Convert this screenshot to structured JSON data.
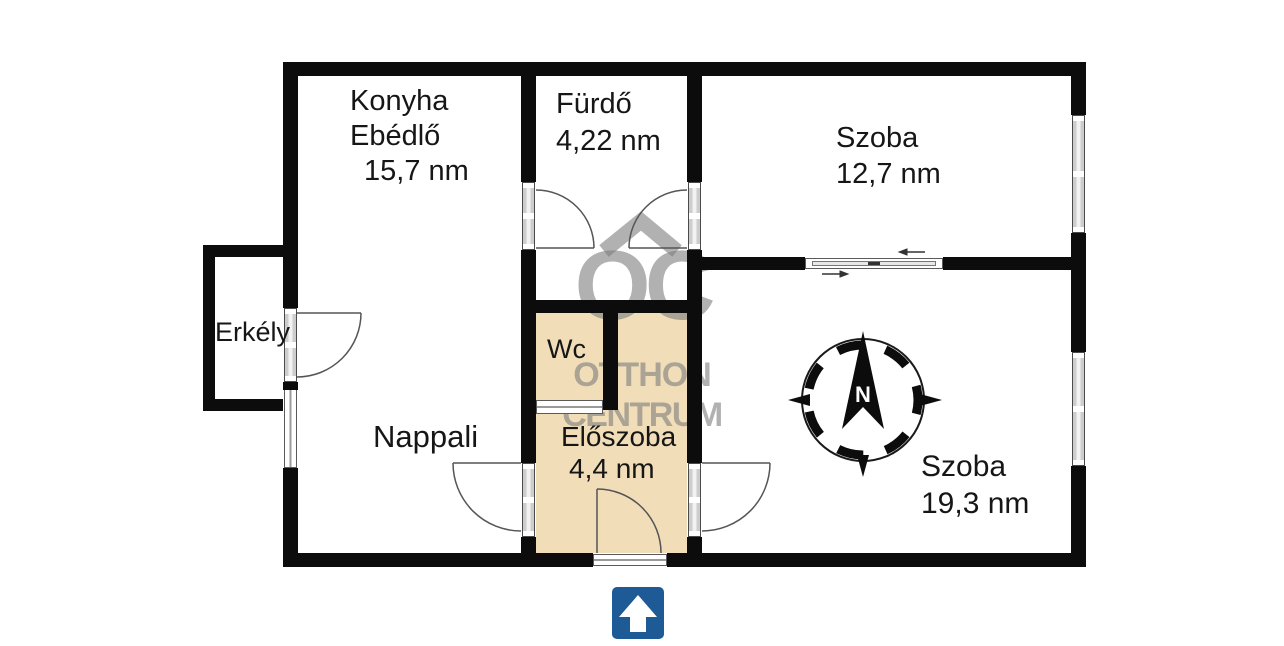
{
  "rooms": {
    "konyha": {
      "line1": "Konyha",
      "line2": "Ebédlő",
      "area": "15,7 nm"
    },
    "furdo": {
      "name": "Fürdő",
      "area": "4,22 nm"
    },
    "szoba_felso": {
      "name": "Szoba",
      "area": "12,7 nm"
    },
    "erkely": {
      "name": "Erkély"
    },
    "wc": {
      "name": "Wc"
    },
    "nappali": {
      "name": "Nappali"
    },
    "eloszoba": {
      "name": "Előszoba",
      "area": "4,4 nm"
    },
    "szoba_also": {
      "name": "Szoba",
      "area": "19,3 nm"
    }
  },
  "compass": {
    "north_label": "N"
  },
  "watermark": {
    "monogram": "OC",
    "name_line1": "OTTHON",
    "name_line2": "CENTRUM"
  },
  "colors": {
    "wall": "#0c0c0c",
    "hall_fill": "#f1deb9",
    "entry_arrow_blue": "#1d5a96",
    "watermark_gray": "rgba(125,125,125,0.6)",
    "door_line": "#555555"
  }
}
